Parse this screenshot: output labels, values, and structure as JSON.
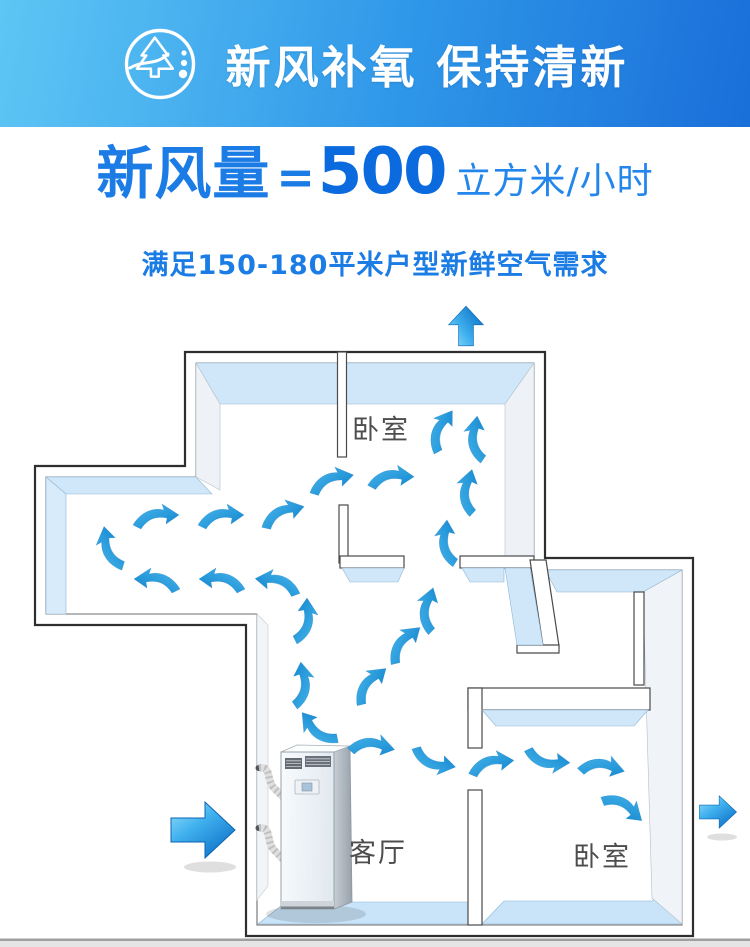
{
  "banner": {
    "title": "新风补氧 保持清新",
    "icon": "pine-tree-fresh-air-icon"
  },
  "headline": {
    "label": "新风量",
    "equals": "=",
    "value": "500",
    "unit": "立方米/小时"
  },
  "subtitle": "满足150-180平米户型新鲜空气需求",
  "floorplan": {
    "rooms": [
      {
        "label": "卧室",
        "position": "top"
      },
      {
        "label": "客厅",
        "position": "center-bottom"
      },
      {
        "label": "卧室",
        "position": "bottom-right"
      }
    ],
    "unit_name": "fresh-air-ventilation-unit",
    "big_arrows": [
      {
        "name": "air-intake-arrow-left",
        "direction": "right"
      },
      {
        "name": "air-exhaust-arrow-top",
        "direction": "up"
      },
      {
        "name": "air-exhaust-arrow-right",
        "direction": "right"
      }
    ],
    "flow_arrow_count": 25
  },
  "colors": {
    "banner_gradient_start": "#5ec6f4",
    "banner_gradient_mid": "#2e96e8",
    "banner_gradient_end": "#1a6fd9",
    "headline_blue": "#1c7ce6",
    "value_blue": "#0a6ade",
    "unit_text_blue": "#2286ec",
    "subtitle_blue": "#1a7ce4",
    "arrow_blue_light": "#45b6ec",
    "arrow_blue_dark": "#1286cc",
    "wall_face_blue": "#cfe7f9",
    "floor_blue": "#c9e4f8",
    "room_label_gray": "#4d4d4d",
    "wall_outline": "#2e2e2e"
  }
}
